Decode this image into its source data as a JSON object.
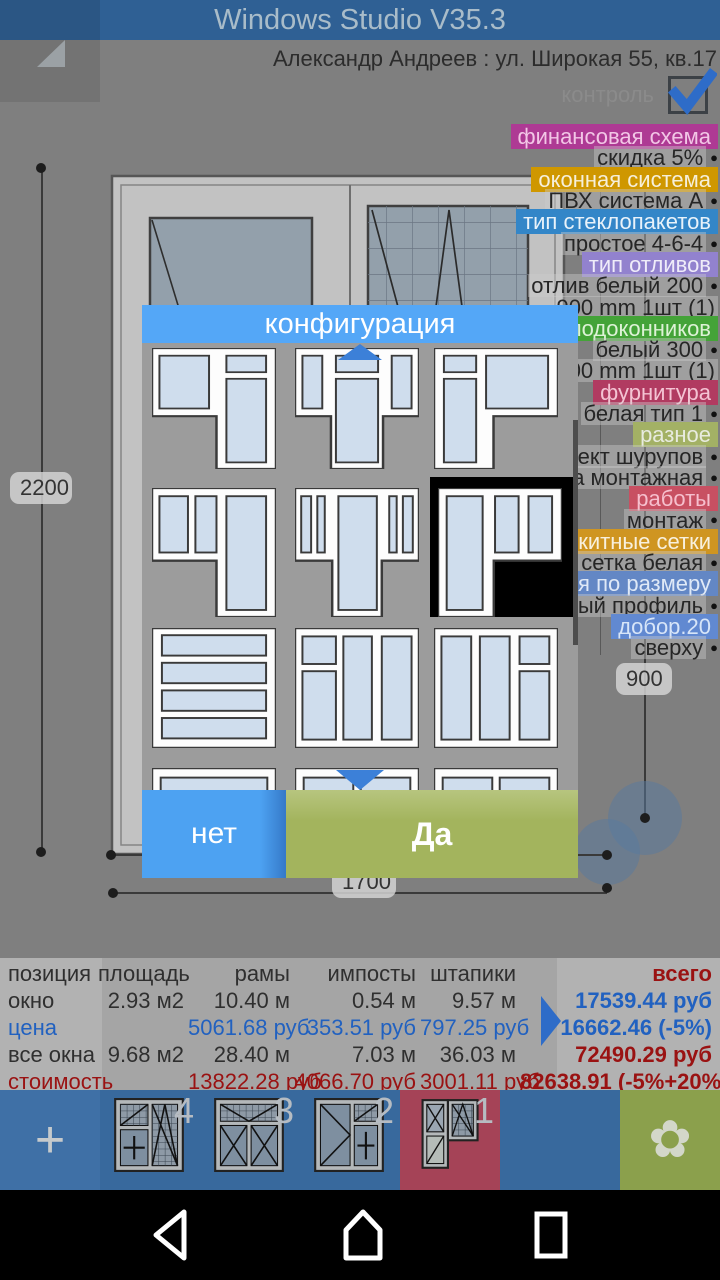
{
  "header": {
    "title": "Windows Studio V35.3",
    "customer": "Александр Андреев : ул. Широкая 55, кв.17",
    "control_label": "контроль",
    "control_checked": true
  },
  "canvas": {
    "dim_left": "2200",
    "dim_right": "900",
    "dim_bottom": "1700"
  },
  "specs": [
    {
      "kind": "header",
      "label": "финансовая схема",
      "color": "#ae3a94",
      "text_color": "#f2c6e6"
    },
    {
      "kind": "item",
      "label": "скидка 5%",
      "bullet": true
    },
    {
      "kind": "header",
      "label": "оконная система",
      "color": "#cf9700",
      "text_color": "#f6efda"
    },
    {
      "kind": "item",
      "label": "ПВХ система А",
      "bullet": true
    },
    {
      "kind": "header",
      "label": "тип стеклопакетов",
      "color": "#3386c8",
      "text_color": "#e8f2fa"
    },
    {
      "kind": "item",
      "label": "простое 4-6-4",
      "bullet": true
    },
    {
      "kind": "header",
      "label": "тип отливов",
      "color": "#9282ce",
      "text_color": "#efecf9"
    },
    {
      "kind": "item",
      "label": "отлив белый 200",
      "bullet": true
    },
    {
      "kind": "item",
      "label": "900 mm  1шт (1)",
      "bullet": false
    },
    {
      "kind": "header",
      "label": "п подоконников",
      "color": "#44a338",
      "text_color": "#ddf2d6"
    },
    {
      "kind": "item",
      "label": "белый 300",
      "bullet": true
    },
    {
      "kind": "item",
      "label": "900 mm  1шт (1)",
      "bullet": false
    },
    {
      "kind": "header",
      "label": "фурнитура",
      "color": "#b13b61",
      "text_color": "#f4c3d3"
    },
    {
      "kind": "item",
      "label": "белая тип 1",
      "bullet": true
    },
    {
      "kind": "header",
      "label": "разное",
      "color": "#a3b165",
      "text_color": "#e8ebdf"
    },
    {
      "kind": "item",
      "label": "плект шурупов",
      "bullet": true
    },
    {
      "kind": "item",
      "label": "ена монтажная",
      "bullet": true
    },
    {
      "kind": "header",
      "label": "работы",
      "color": "#c85062",
      "text_color": "#f6bfcd"
    },
    {
      "kind": "item",
      "label": "монтаж",
      "bullet": true
    },
    {
      "kind": "header",
      "label": "оскитные сетки",
      "color": "#cf9521",
      "text_color": "#f8f0dd"
    },
    {
      "kind": "item",
      "label": "сетка белая",
      "bullet": true
    },
    {
      "kind": "header",
      "label": "ния по размеру",
      "color": "#6387c5",
      "text_color": "#dfe9f7"
    },
    {
      "kind": "item",
      "label": "чный  профиль",
      "bullet": true
    },
    {
      "kind": "header",
      "label": "добор.20",
      "color": "#6189d1",
      "text_color": "#d7e5f8"
    },
    {
      "kind": "item",
      "label": "сверху",
      "bullet": true
    }
  ],
  "dialog": {
    "title": "конфигурация",
    "cancel_label": "нет",
    "confirm_label": "Да",
    "tiles": [
      {
        "shape": "door-right",
        "selected": false
      },
      {
        "shape": "door-center",
        "selected": false
      },
      {
        "shape": "door-left",
        "selected": false
      },
      {
        "shape": "panes2-door-right",
        "selected": false
      },
      {
        "shape": "narrow-door-center",
        "selected": false
      },
      {
        "shape": "door-left-2panes",
        "selected": true
      },
      {
        "shape": "slats4",
        "selected": false
      },
      {
        "shape": "split-left",
        "selected": false
      },
      {
        "shape": "split-right",
        "selected": false
      },
      {
        "shape": "stub-wide",
        "selected": false
      },
      {
        "shape": "stub-two",
        "selected": false
      },
      {
        "shape": "stub-two",
        "selected": false
      }
    ]
  },
  "table": {
    "columns": [
      "позиция",
      "площадь",
      "рамы",
      "импосты",
      "штапики",
      "всего"
    ],
    "rows": [
      {
        "name": "окно",
        "style": "dark",
        "cells": [
          "2.93 м2",
          "10.40 м",
          "0.54 м",
          "9.57 м"
        ],
        "total": "17539.44 руб",
        "total_style": "blue"
      },
      {
        "name": "цена",
        "style": "blue",
        "cells": [
          "",
          "5061.68  руб",
          "353.51  руб",
          "797.25  руб"
        ],
        "total": "16662.46 (-5%)",
        "total_style": "blue"
      },
      {
        "name": "все окна",
        "style": "dark",
        "cells": [
          "9.68 м2",
          "28.40 м",
          "7.03 м",
          "36.03 м"
        ],
        "total": "72490.29 руб",
        "total_style": "red"
      },
      {
        "name": "стоимость",
        "style": "red",
        "cells": [
          "",
          "13822.28  руб",
          "4066.70  руб",
          "3001.11  руб"
        ],
        "total": "82638.91 (-5%+20%)",
        "total_style": "red"
      }
    ]
  },
  "tabbar": {
    "add_label": "+",
    "tabs": [
      {
        "number": "4",
        "icon": "win4",
        "selected": false
      },
      {
        "number": "3",
        "icon": "win3",
        "selected": false
      },
      {
        "number": "2",
        "icon": "win2",
        "selected": false
      },
      {
        "number": "1",
        "icon": "win1",
        "selected": true
      }
    ],
    "flower_icon": "✿"
  },
  "colors": {
    "titlebar_blue": "#2f6094",
    "dialog_blue": "#54a7f7",
    "confirm_green": "#a3b45d",
    "cancel_blue": "#4da2f2",
    "selected_tab_red": "#a54357",
    "flower_green": "#8ba04c",
    "table_blue": "#2161c0",
    "table_red": "#9a1212"
  }
}
